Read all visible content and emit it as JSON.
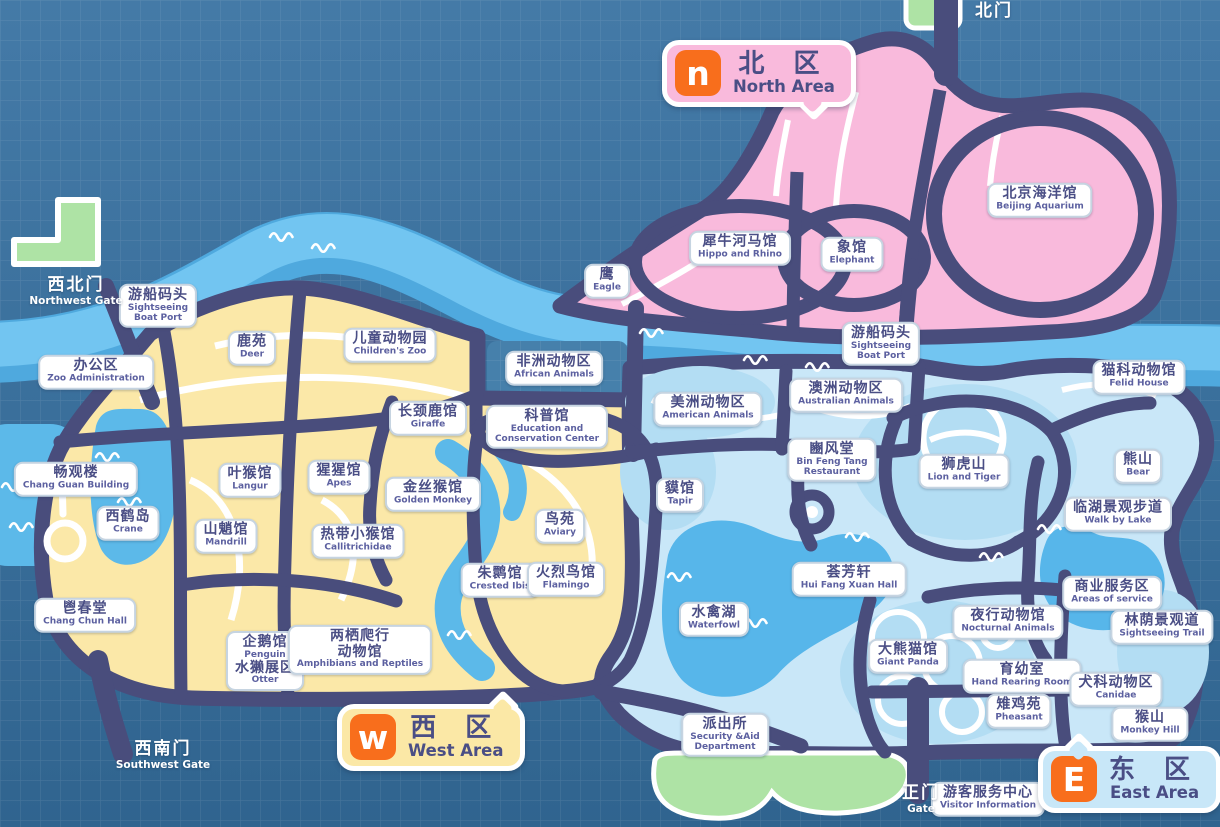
{
  "badges": {
    "north": {
      "letter": "n",
      "zh": "北 区",
      "en": "North Area"
    },
    "west": {
      "letter": "w",
      "zh": "西 区",
      "en": "West Area"
    },
    "east": {
      "letter": "E",
      "zh": "东 区",
      "en": "East Area"
    }
  },
  "gates": [
    {
      "id": "northwest",
      "zh": "西北门",
      "en": "Northwest Gate",
      "x": 76,
      "y": 276
    },
    {
      "id": "north",
      "zh": "北门",
      "en": "",
      "x": 994,
      "y": 2
    },
    {
      "id": "southwest",
      "zh": "西南门",
      "en": "Southwest Gate",
      "x": 163,
      "y": 740
    },
    {
      "id": "main",
      "zh": "正门",
      "en": "Gate",
      "x": 921,
      "y": 784
    }
  ],
  "pois": [
    {
      "id": "boat-port-west",
      "zh": "游船码头",
      "en": "Sightseeing\nBoat Port",
      "x": 158,
      "y": 306
    },
    {
      "id": "zoo-administration",
      "zh": "办公区",
      "en": "Zoo Administration",
      "x": 96,
      "y": 372
    },
    {
      "id": "deer",
      "zh": "鹿苑",
      "en": "Deer",
      "x": 252,
      "y": 348
    },
    {
      "id": "childrens-zoo",
      "zh": "儿童动物园",
      "en": "Children's Zoo",
      "x": 390,
      "y": 345
    },
    {
      "id": "african-animals",
      "zh": "非洲动物区",
      "en": "African Animals",
      "x": 554,
      "y": 368
    },
    {
      "id": "giraffe",
      "zh": "长颈鹿馆",
      "en": "Giraffe",
      "x": 428,
      "y": 418
    },
    {
      "id": "education-center",
      "zh": "科普馆",
      "en": "Education and\nConservation Center",
      "x": 547,
      "y": 427
    },
    {
      "id": "chang-guan-building",
      "zh": "畅观楼",
      "en": "Chang Guan Building",
      "x": 76,
      "y": 479
    },
    {
      "id": "crane",
      "zh": "西鹤岛",
      "en": "Crane",
      "x": 128,
      "y": 523
    },
    {
      "id": "langur",
      "zh": "叶猴馆",
      "en": "Langur",
      "x": 250,
      "y": 480
    },
    {
      "id": "mandrill",
      "zh": "山魈馆",
      "en": "Mandrill",
      "x": 226,
      "y": 536
    },
    {
      "id": "apes",
      "zh": "猩猩馆",
      "en": "Apes",
      "x": 339,
      "y": 477
    },
    {
      "id": "golden-monkey",
      "zh": "金丝猴馆",
      "en": "Golden Monkey",
      "x": 433,
      "y": 494
    },
    {
      "id": "callitrichidae",
      "zh": "热带小猴馆",
      "en": "Callitrichidae",
      "x": 358,
      "y": 541
    },
    {
      "id": "aviary",
      "zh": "鸟苑",
      "en": "Aviary",
      "x": 560,
      "y": 526
    },
    {
      "id": "crested-ibis",
      "zh": "朱鹮馆",
      "en": "Crested Ibis",
      "x": 500,
      "y": 580
    },
    {
      "id": "flamingo",
      "zh": "火烈鸟馆",
      "en": "Flamingo",
      "x": 566,
      "y": 579
    },
    {
      "id": "chang-chun-hall",
      "zh": "鬯春堂",
      "en": "Chang Chun Hall",
      "x": 85,
      "y": 615
    },
    {
      "id": "penguin-otter",
      "rows": [
        {
          "zh": "企鹅馆",
          "en": "Penguin"
        },
        {
          "zh": "水獭展区",
          "en": "Otter"
        }
      ],
      "x": 265,
      "y": 661
    },
    {
      "id": "amphibians-reptiles",
      "zh": "两栖爬行\n动物馆",
      "en": "Amphibians and Reptiles",
      "x": 360,
      "y": 650
    },
    {
      "id": "eagle",
      "zh": "鹰",
      "en": "Eagle",
      "x": 607,
      "y": 281
    },
    {
      "id": "hippo-rhino",
      "zh": "犀牛河马馆",
      "en": "Hippo and Rhino",
      "x": 740,
      "y": 248
    },
    {
      "id": "elephant",
      "zh": "象馆",
      "en": "Elephant",
      "x": 852,
      "y": 254
    },
    {
      "id": "beijing-aquarium",
      "zh": "北京海洋馆",
      "en": "Beijing Aquarium",
      "x": 1040,
      "y": 200
    },
    {
      "id": "boat-port-north",
      "zh": "游船码头",
      "en": "Sightseeing\nBoat Port",
      "x": 881,
      "y": 344
    },
    {
      "id": "american-animals",
      "zh": "美洲动物区",
      "en": "American Animals",
      "x": 708,
      "y": 409
    },
    {
      "id": "australian-animals",
      "zh": "澳洲动物区",
      "en": "Australian Animals",
      "x": 846,
      "y": 395
    },
    {
      "id": "felid-house",
      "zh": "猫科动物馆",
      "en": "Felid House",
      "x": 1139,
      "y": 377
    },
    {
      "id": "tapir",
      "zh": "貘馆",
      "en": "Tapir",
      "x": 680,
      "y": 495
    },
    {
      "id": "bin-feng-tang",
      "zh": "豳风堂",
      "en": "Bin Feng Tang\nRestaurant",
      "x": 832,
      "y": 460
    },
    {
      "id": "lion-tiger",
      "zh": "狮虎山",
      "en": "Lion and Tiger",
      "x": 964,
      "y": 471
    },
    {
      "id": "bear",
      "zh": "熊山",
      "en": "Bear",
      "x": 1138,
      "y": 466
    },
    {
      "id": "walk-by-lake",
      "zh": "临湖景观步道",
      "en": "Walk by Lake",
      "x": 1118,
      "y": 514
    },
    {
      "id": "areas-of-service",
      "zh": "商业服务区",
      "en": "Areas of service",
      "x": 1112,
      "y": 593
    },
    {
      "id": "sightseeing-trail",
      "zh": "林荫景观道",
      "en": "Sightseeing Trail",
      "x": 1162,
      "y": 627
    },
    {
      "id": "waterfowl-lake",
      "zh": "水禽湖",
      "en": "Waterfowl",
      "x": 714,
      "y": 619
    },
    {
      "id": "hui-fang-xuan",
      "zh": "荟芳轩",
      "en": "Hui Fang Xuan Hall",
      "x": 849,
      "y": 579
    },
    {
      "id": "nocturnal-animals",
      "zh": "夜行动物馆",
      "en": "Nocturnal Animals",
      "x": 1008,
      "y": 622
    },
    {
      "id": "giant-panda",
      "zh": "大熊猫馆",
      "en": "Giant Panda",
      "x": 908,
      "y": 656
    },
    {
      "id": "hand-rearing-room",
      "zh": "育幼室",
      "en": "Hand Rearing Room",
      "x": 1022,
      "y": 676
    },
    {
      "id": "pheasant",
      "zh": "雉鸡苑",
      "en": "Pheasant",
      "x": 1019,
      "y": 711
    },
    {
      "id": "canidae",
      "zh": "犬科动物区",
      "en": "Canidae",
      "x": 1116,
      "y": 689
    },
    {
      "id": "monkey-hill",
      "zh": "猴山",
      "en": "Monkey Hill",
      "x": 1150,
      "y": 724
    },
    {
      "id": "police-station",
      "zh": "派出所",
      "en": "Security &Aid\nDepartment",
      "x": 725,
      "y": 735
    },
    {
      "id": "visitor-information",
      "zh": "游客服务中心",
      "en": "Visitor Information",
      "x": 988,
      "y": 799
    }
  ],
  "colors": {
    "background": "#3d72a0",
    "road": "#494d7c",
    "north_area": "#f9badc",
    "west_area": "#fbe8a8",
    "east_area": "#c9e7f8",
    "water": "#5cb9e9",
    "river_light": "#72c5f1",
    "gate_green": "#aee3a5",
    "accent_orange": "#f86e1c",
    "label_text": "#4a4e85"
  }
}
